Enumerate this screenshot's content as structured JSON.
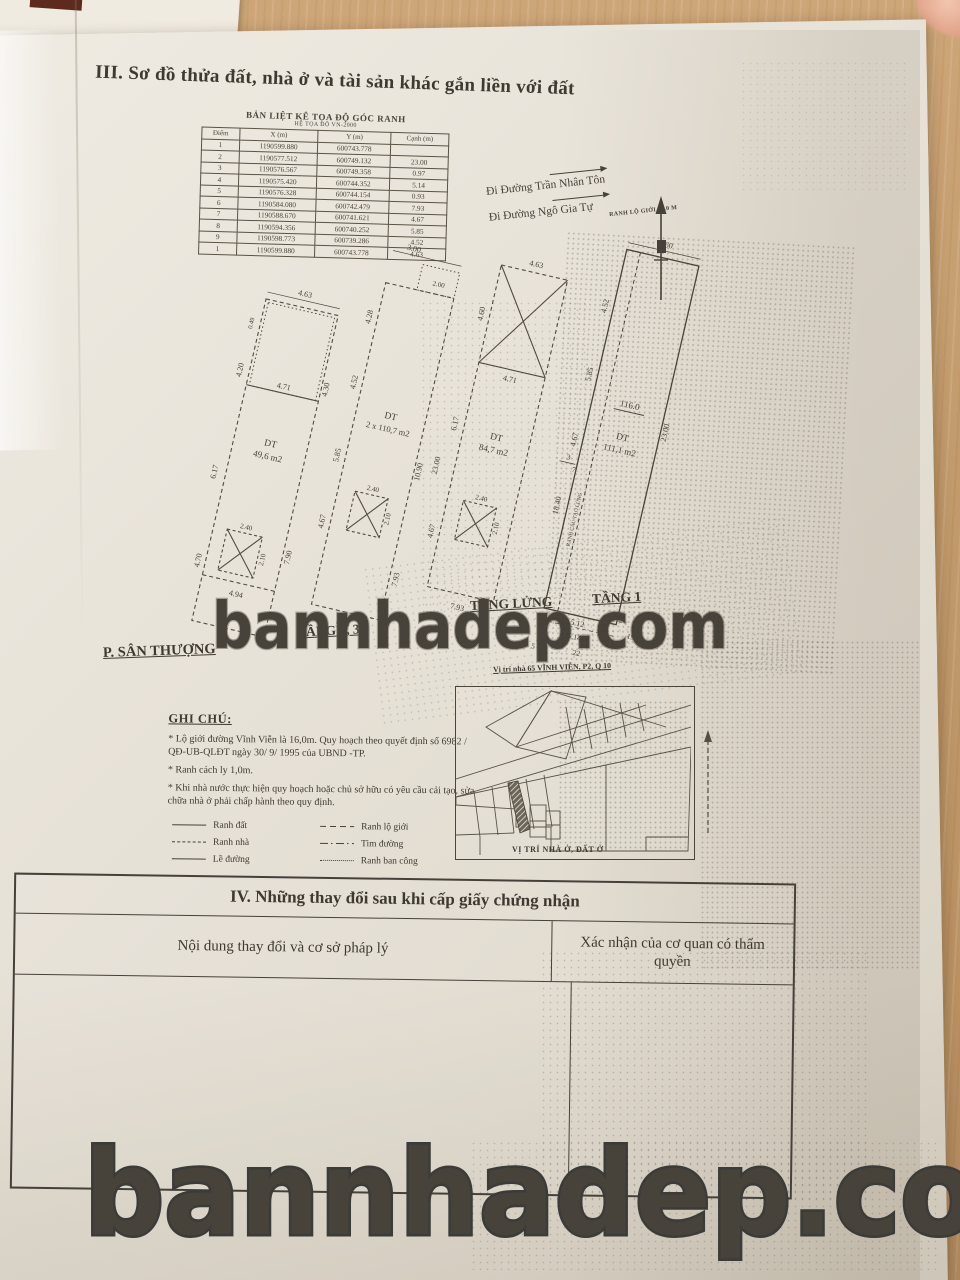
{
  "page": {
    "section3_title": "III. Sơ đồ thửa đất, nhà ở và tài sản khác gắn liền với đất",
    "section4_title": "IV. Những thay đổi sau khi cấp giấy chứng nhận",
    "section4_col1": "Nội dung thay đổi và cơ sở pháp lý",
    "section4_col2": "Xác nhận của cơ quan có thẩm quyền"
  },
  "watermark": {
    "text": "bannhadep.com"
  },
  "coord_table": {
    "title": "BẢN LIỆT KÊ TỌA ĐỘ GÓC RANH",
    "subtitle": "HỆ TỌA ĐỘ VN-2000",
    "headers": [
      "Điểm",
      "X (m)",
      "Y (m)",
      "Cạnh (m)"
    ],
    "rows": [
      [
        "1",
        "1190599.880",
        "600743.778",
        ""
      ],
      [
        "2",
        "1190577.512",
        "600749.132",
        "23.00"
      ],
      [
        "3",
        "1190576.567",
        "600749.358",
        "0.97"
      ],
      [
        "4",
        "1190575.420",
        "600744.352",
        "5.14"
      ],
      [
        "5",
        "1190576.328",
        "600744.154",
        "0.93"
      ],
      [
        "6",
        "1190584.080",
        "600742.479",
        "7.93"
      ],
      [
        "7",
        "1190588.670",
        "600741.621",
        "4.67"
      ],
      [
        "8",
        "1190594.356",
        "600740.252",
        "5.85"
      ],
      [
        "9",
        "1190598.773",
        "600739.286",
        "4.52"
      ],
      [
        "1",
        "1190599.880",
        "600743.778",
        "4.63"
      ]
    ]
  },
  "streets": {
    "street1": "Đi Đường Trần Nhân Tôn",
    "street2": "Đi Đường Ngô Gia Tự",
    "ranh_lo_gioi": "RANH LỘ GIỚI 16.0 M"
  },
  "plans": [
    {
      "label": "P. SÂN THƯỢNG",
      "area1": "DT",
      "area2": "49,6 m2",
      "dims": {
        "top": "4.63",
        "tops": "0.49",
        "l1": "4.20",
        "l2": "6.17",
        "l3": "4.70",
        "r1": "4.30",
        "r2": "7.90",
        "in1": "4.71",
        "in2": "4.94",
        "bottom": "5.12",
        "sw": "2.40",
        "sh": "2.10"
      }
    },
    {
      "label": "TẦNG 2, 3",
      "area1": "DT",
      "area2": "2 x 110,7 m2",
      "dims": {
        "top": "3.00",
        "bal": "2.00",
        "l1": "4.28",
        "l2": "4.52",
        "l3": "5.85",
        "l4": "4.67",
        "r1": "10.90",
        "r2": "7.93",
        "bottom": "5.12",
        "sw": "2.40",
        "sh": "2.10"
      }
    },
    {
      "label": "TẦNG LỬNG",
      "area1": "DT",
      "area2": "84,7 m2",
      "dims": {
        "top": "4.63",
        "l1": "4.60",
        "l2": "6.17",
        "l3": "23.00",
        "l4": "4.67",
        "in1": "4.71",
        "bottom": "7.93",
        "sw": "2.40",
        "sh": "2.10"
      }
    },
    {
      "label": "TẦNG 1",
      "area1": "DT",
      "area2": "111,1 m2",
      "parcel": "116.0",
      "ranh": "RANH CẤU TẠO LỬNG",
      "dims": {
        "top": "4.60",
        "l1": "4.52",
        "l2": "5.85",
        "l3": "4.67",
        "l4": "18.40",
        "r1": "23.00",
        "b1": "5.12",
        "b2": "5.14"
      },
      "points": [
        "3",
        "7",
        "2",
        "19",
        "22",
        "4",
        "5"
      ]
    }
  ],
  "site_caption": "Vị trí nhà 65 VĨNH VIỄN, P2, Q 10",
  "map_caption": "VỊ TRÍ NHÀ Ở, ĐẤT Ở",
  "notes": {
    "title": "GHI CHÚ:",
    "items": [
      "* Lộ giới đường Vĩnh Viễn là 16,0m. Quy hoạch theo quyết định số 6982 / QĐ-UB-QLĐT  ngày 30/ 9/ 1995 của UBND -TP.",
      "* Ranh cách ly 1,0m.",
      "* Khi nhà nước thực hiện quy hoạch hoặc chủ sở hữu có yêu cầu cải tạo, sửa chữa nhà ở phải chấp hành theo quy định."
    ]
  },
  "legend": {
    "items": [
      {
        "label": "Ranh đất"
      },
      {
        "label": "Ranh nhà"
      },
      {
        "label": "Lề đường"
      },
      {
        "label": "Ranh lộ giới"
      },
      {
        "label": "Tim đường"
      },
      {
        "label": "Ranh ban công"
      }
    ]
  },
  "colors": {
    "paper": "#e8e3d9",
    "desk": "#c1996a",
    "ink": "#3f3a31"
  }
}
